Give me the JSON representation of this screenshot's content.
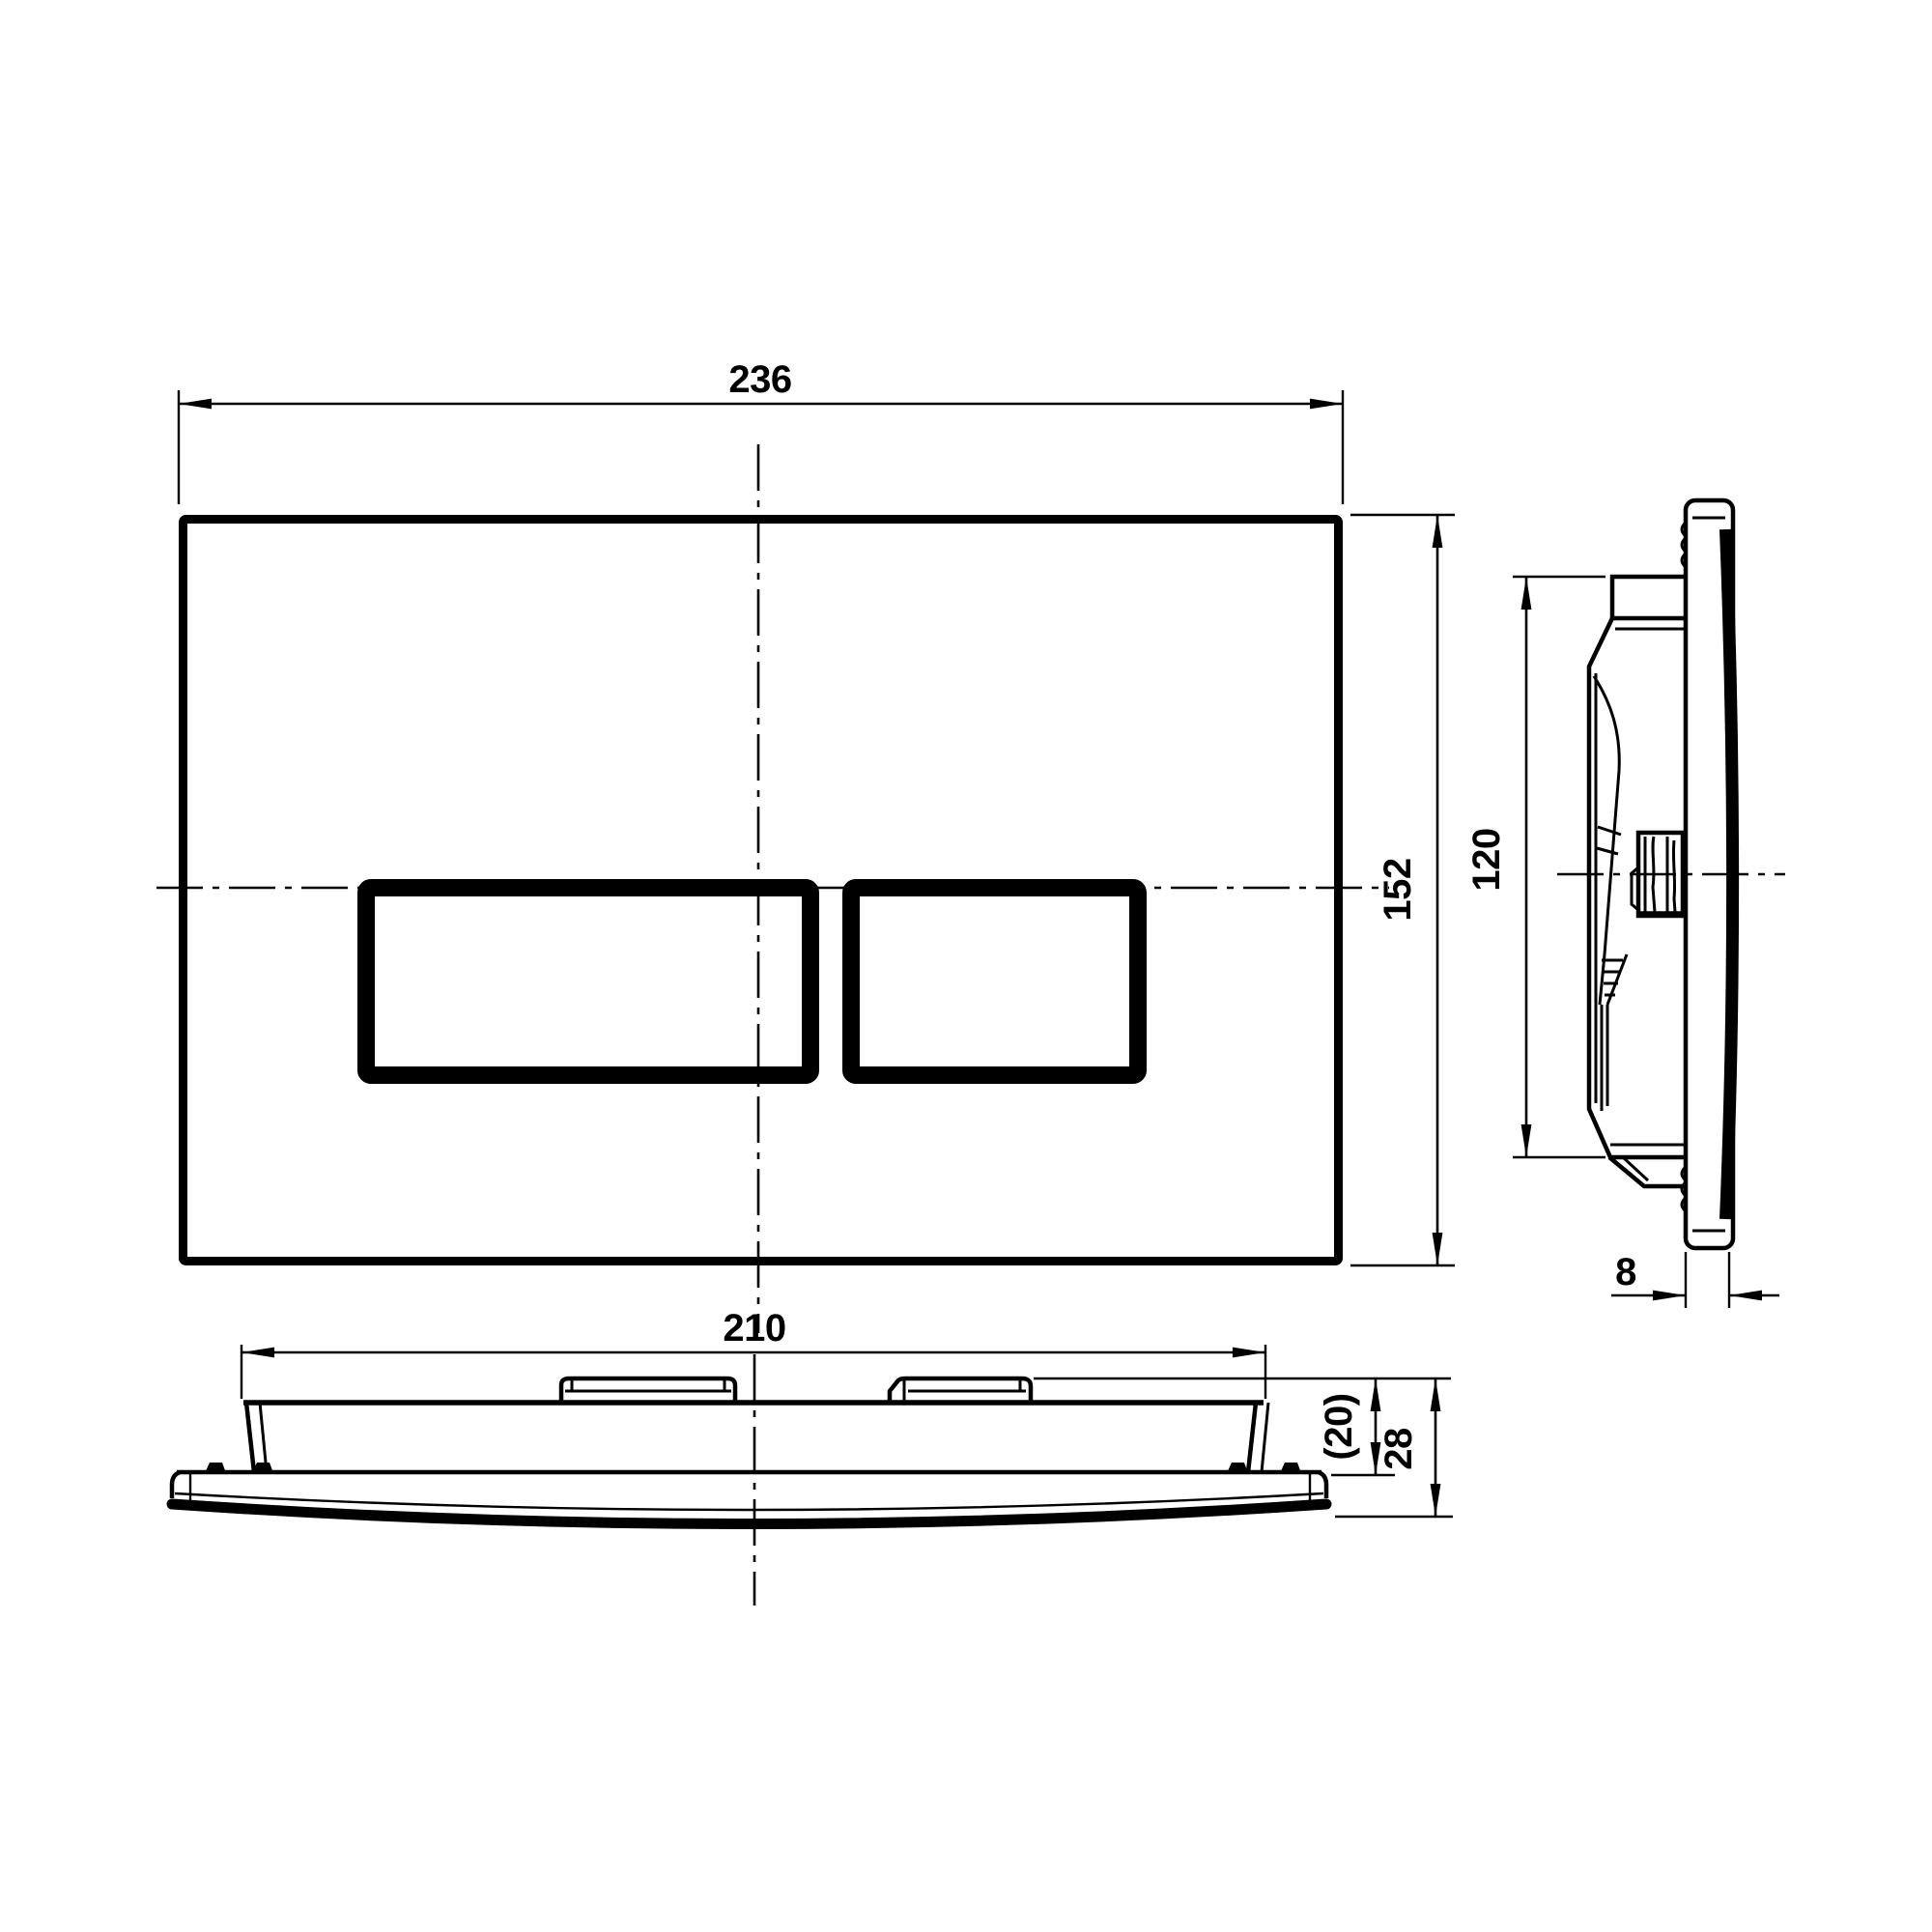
{
  "colors": {
    "background": "#ffffff",
    "line": "#000000"
  },
  "dims": {
    "front_width": "236",
    "front_height": "152",
    "side_mech_height": "120",
    "side_plate_thickness": "8",
    "bottom_width": "210",
    "bottom_inner_depth": "(20)",
    "bottom_total_depth": "28"
  }
}
